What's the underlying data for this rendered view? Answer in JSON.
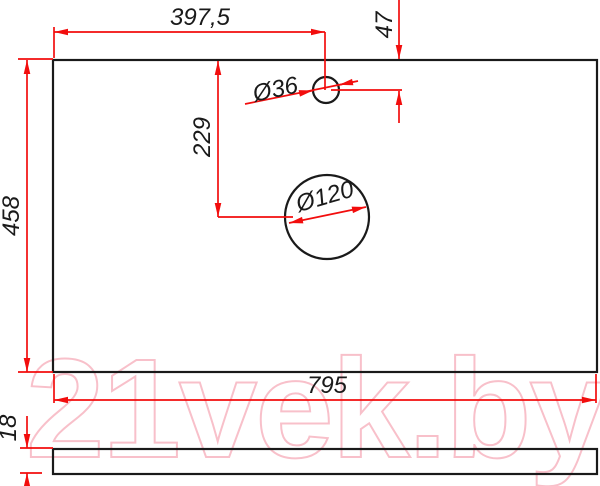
{
  "dimensions": {
    "top_width": "397,5",
    "top_offset": "47",
    "small_hole_diameter": "Ø36",
    "large_hole_diameter": "Ø120",
    "hole_center_offset": "229",
    "panel_depth": "458",
    "panel_width": "795",
    "panel_thickness": "18"
  },
  "watermark": {
    "text": "21vek.by"
  },
  "colors": {
    "dimension_red": "#f20d0d",
    "outline_black": "#1a1a1a",
    "watermark_pink": "#f8c0ca"
  }
}
